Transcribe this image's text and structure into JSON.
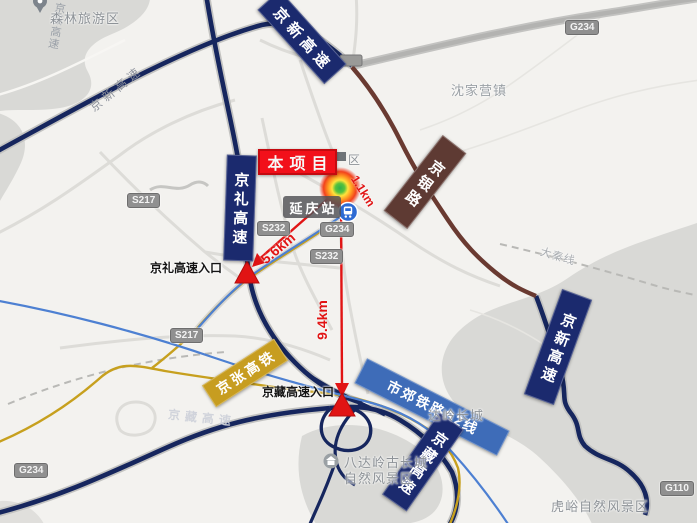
{
  "map": {
    "project": {
      "box_label": "本项目"
    },
    "station": {
      "label": "延庆站"
    },
    "distances": {
      "to_station": "1.1km",
      "to_jingli_entrance": "5.6km",
      "to_jingzang_entrance": "9.4km"
    },
    "entrances": {
      "jingli": "京礼高速入口",
      "jingzang": "京藏高速入口"
    },
    "banners": {
      "jingxin_top": "京新高速",
      "jingli": "京礼高速",
      "jingyin": "京银路",
      "jingxin_right": "京新高速",
      "jingzhang": "京张高铁",
      "s2": "市郊铁路S2线",
      "jingzang": "京藏高速"
    },
    "badges": {
      "s217_nw": "S217",
      "s217_s": "S217",
      "g234_ne": "G234",
      "g234_center": "G234",
      "g234_sw": "G234",
      "s232_w": "S232",
      "s232_s": "S232",
      "g110_se": "G110"
    },
    "places": {
      "forest": "森林旅游区",
      "shenjiaying": "沈家营镇",
      "daqin_line": "大秦线",
      "badaling_wall": "达岭长城",
      "badaling_scenic_line1": "八达岭古长城",
      "badaling_scenic_line2": "自然风景区",
      "huyu": "虎峪自然风景区",
      "district_fragment": "区"
    },
    "road_labels": {
      "jingxin_onroad_nw": "京新高速",
      "jingxin_onroad_n": "京新高速",
      "jingzang_onroad": "京藏高速"
    },
    "colors": {
      "expressway_navy": "#16265e",
      "jingyin_brown": "#6a3a31",
      "hsr_yellow": "#c7a01e",
      "s2_blue": "#4d80d2",
      "s2_banner_blue": "#3e6cb8",
      "gold_banner": "#c79d20",
      "arrow_red": "#e11414",
      "project_red": "#f2101a"
    }
  }
}
